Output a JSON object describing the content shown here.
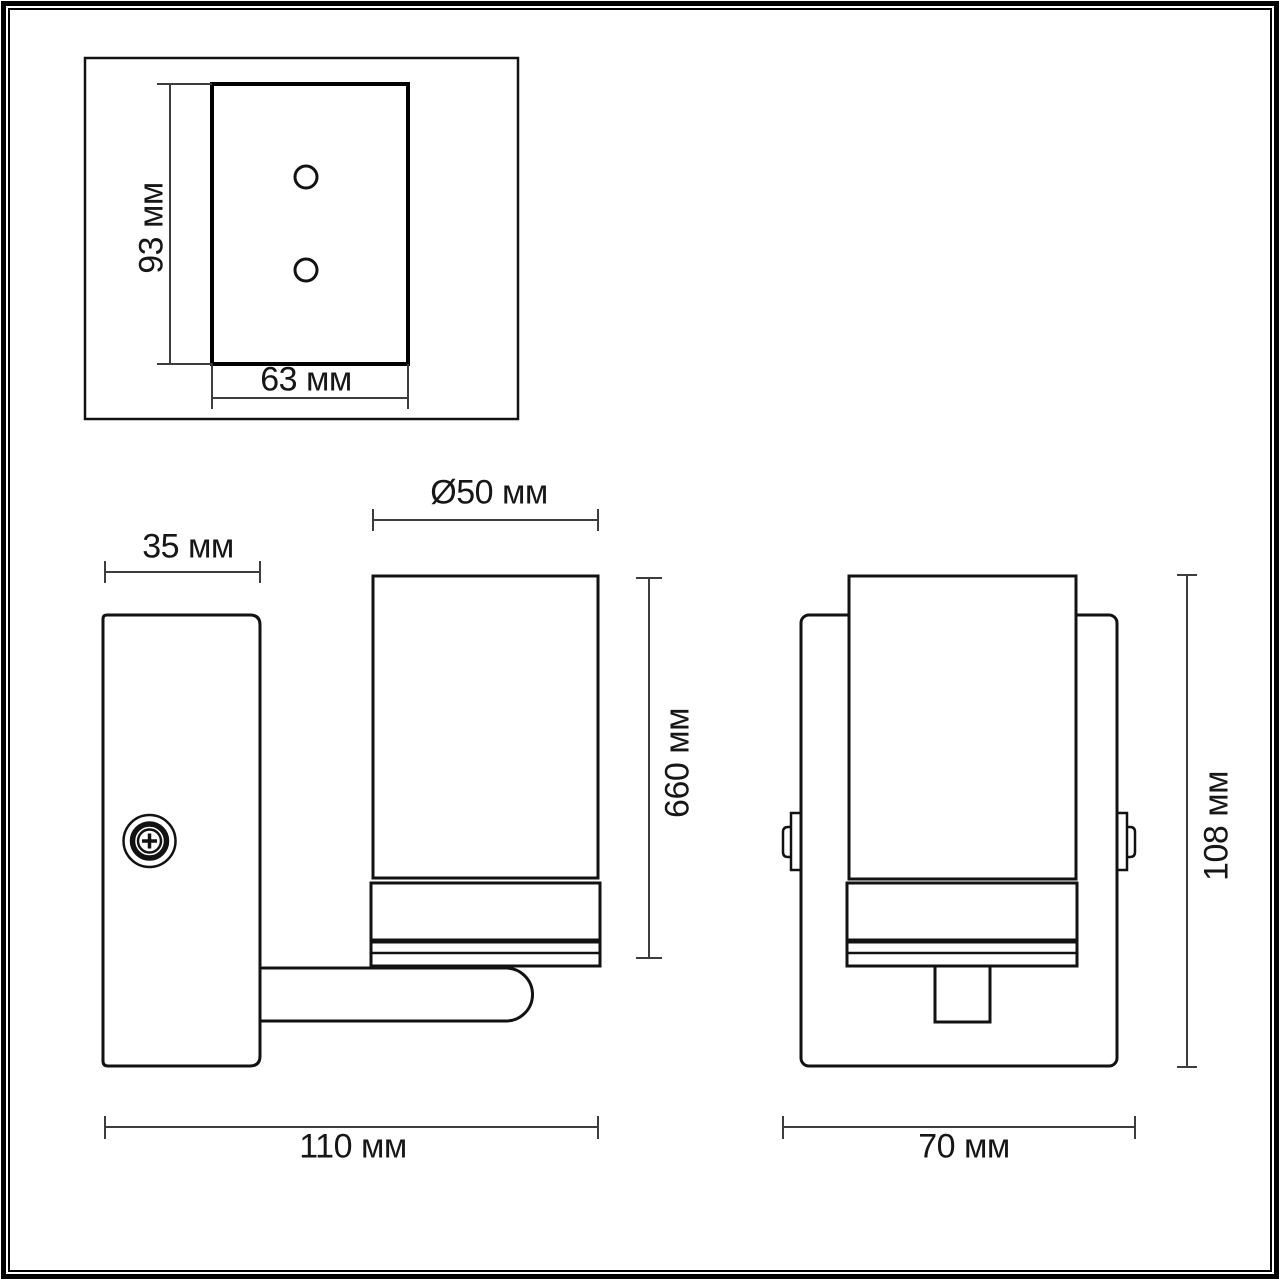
{
  "diagram": {
    "type": "technical-drawing",
    "subject": "wall sconce lamp dimensional drawing",
    "views": {
      "mounting_plate": {
        "height": "93 мм",
        "width": "63 мм"
      },
      "side": {
        "plate_depth": "35 мм",
        "shade_diameter": "Ø50 мм",
        "shade_height": "660 мм",
        "total_depth": "110 мм"
      },
      "front": {
        "total_height": "108 мм",
        "total_width": "70 мм"
      }
    },
    "colors": {
      "line": "#121212",
      "dimension_line": "#3d3d3d",
      "background": "#ffffff"
    }
  }
}
